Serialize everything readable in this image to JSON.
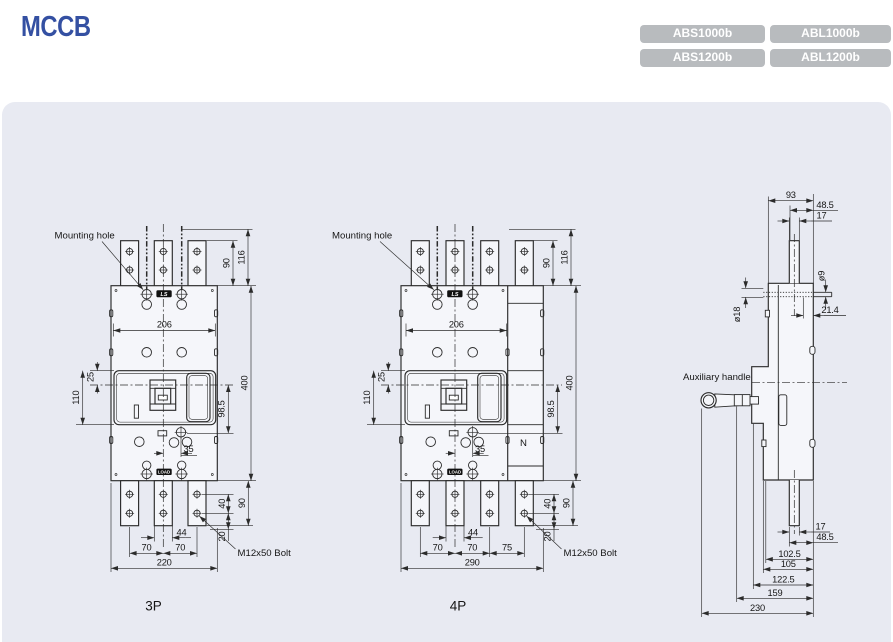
{
  "header": {
    "title": "MCCB"
  },
  "models": {
    "m1": "ABS1000b",
    "m2": "ABL1000b",
    "m3": "ABS1200b",
    "m4": "ABL1200b"
  },
  "front3p": {
    "caption": "3P",
    "mounting_hole": "Mounting hole",
    "bolt": "M12x50 Bolt",
    "brand": "LS",
    "load": "LOAD",
    "dims": {
      "w206": "206",
      "h90": "90",
      "h116": "116",
      "h400": "400",
      "d25": "25",
      "d110": "110",
      "d98": "98.5",
      "d35": "35",
      "d40": "40",
      "d90": "90",
      "d20": "20",
      "d44": "44",
      "d70a": "70",
      "d70b": "70",
      "w220": "220"
    }
  },
  "front4p": {
    "caption": "4P",
    "mounting_hole": "Mounting hole",
    "bolt": "M12x50 Bolt",
    "brand": "LS",
    "load": "LOAD",
    "neutral": "N",
    "dims": {
      "w206": "206",
      "h90": "90",
      "h116": "116",
      "h400": "400",
      "d25": "25",
      "d110": "110",
      "d98": "98.5",
      "d35": "35",
      "d40": "40",
      "d90": "90",
      "d20": "20",
      "d44": "44",
      "d70a": "70",
      "d70b": "70",
      "d75": "75",
      "w290": "290"
    }
  },
  "side": {
    "aux": "Auxiliary handle",
    "dims": {
      "d93": "93",
      "d48t": "48.5",
      "d17t": "17",
      "phi9": "ø9",
      "phi18": "ø18",
      "d21": "21.4",
      "d17b": "17",
      "d48b": "48.5",
      "d102": "102.5",
      "d105": "105",
      "d122": "122.5",
      "d159": "159",
      "d230": "230"
    }
  }
}
